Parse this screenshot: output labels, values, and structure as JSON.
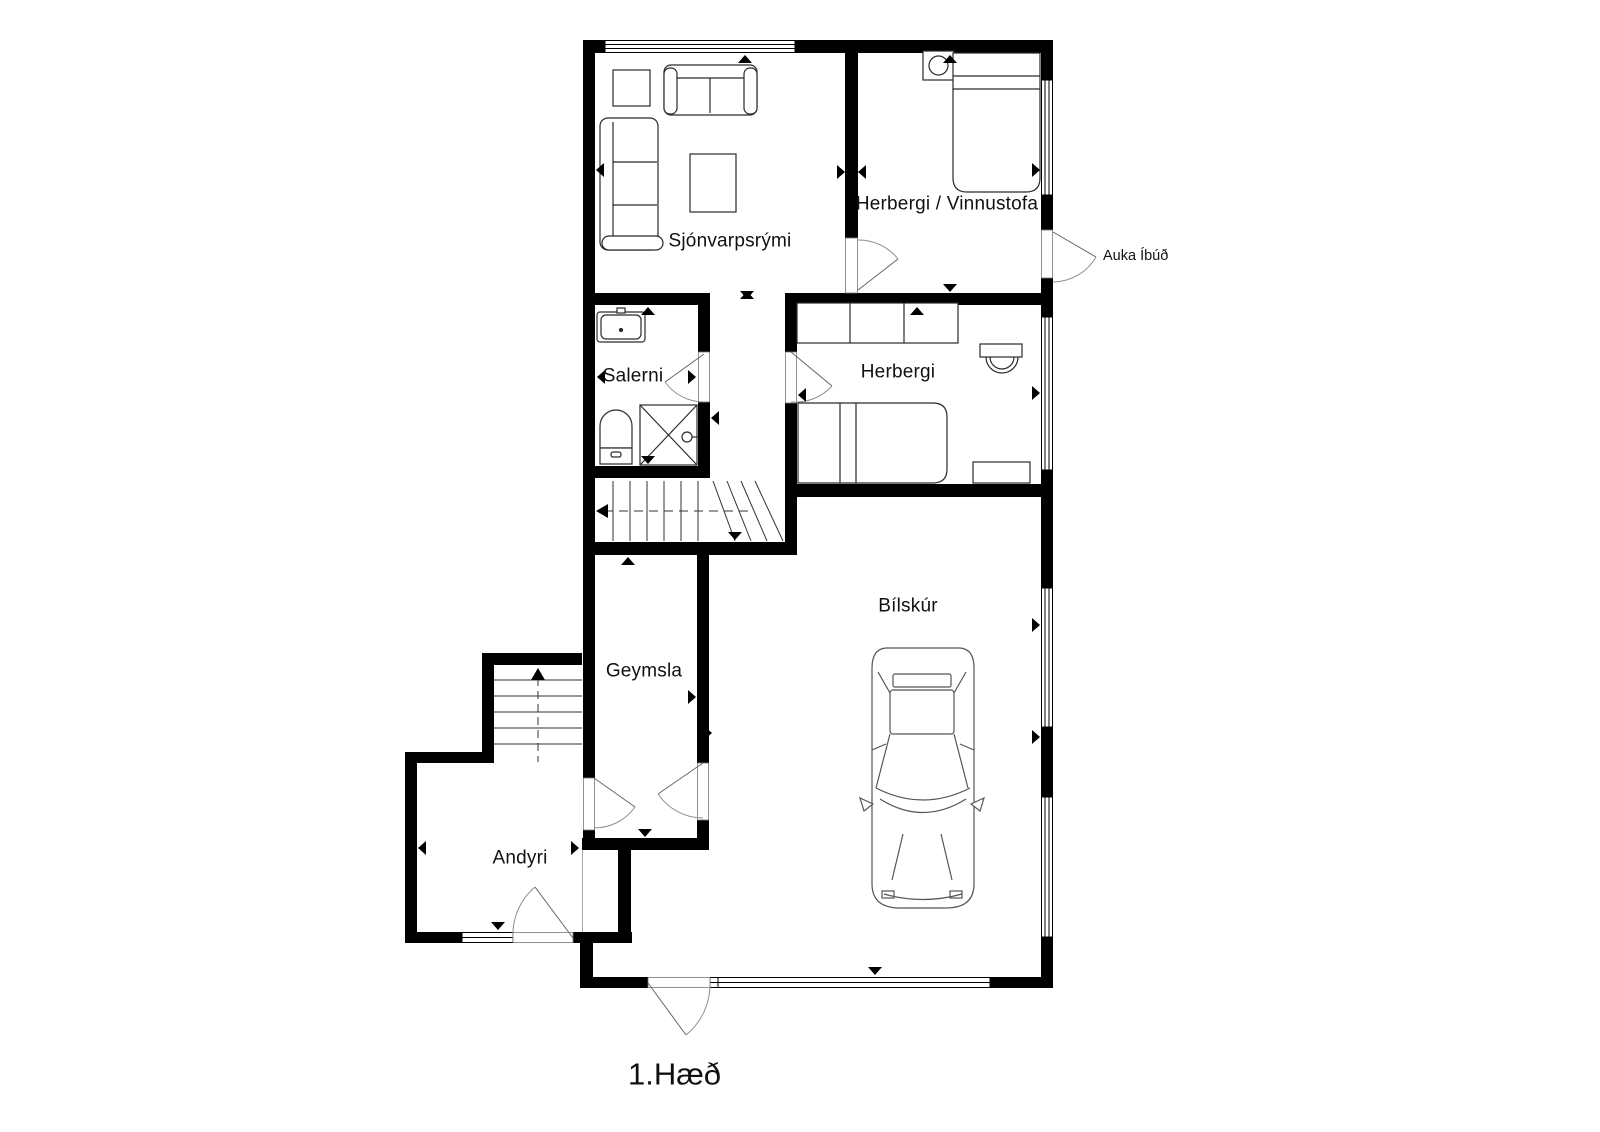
{
  "plan": {
    "floor_title": "1.Hæð",
    "rooms": {
      "tv_room": "Sjónvarpsrými",
      "bedroom_workroom": "Herbergi / Vinnustofa",
      "extra_apartment_entrance": "Auka Íbúð",
      "toilet": "Salerni",
      "bedroom": "Herbergi",
      "garage": "Bílskúr",
      "storage": "Geymsla",
      "entry_hall": "Andyri"
    },
    "colors": {
      "walls": "#000000",
      "background": "#ffffff",
      "door_arc": "#8f8f8f"
    }
  }
}
